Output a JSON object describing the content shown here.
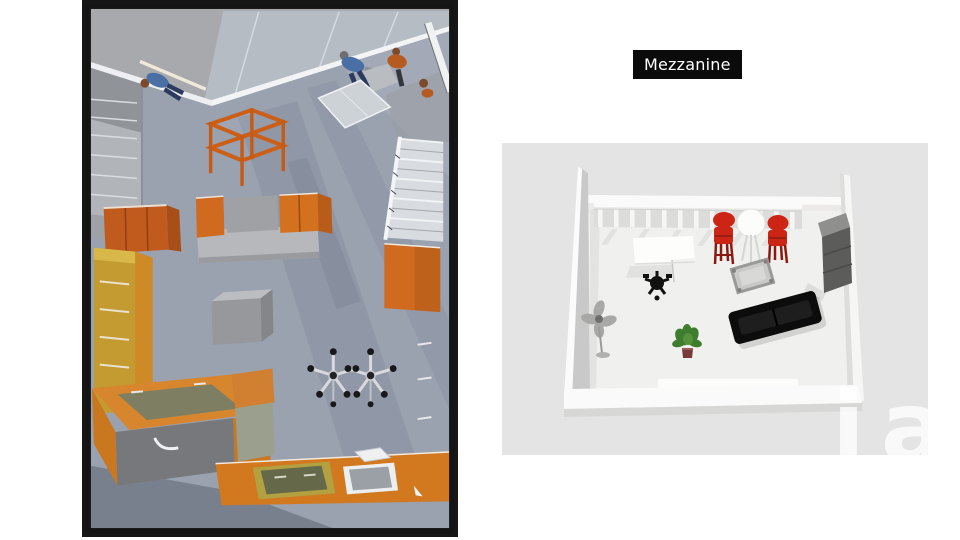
{
  "page": {
    "background": "#ffffff"
  },
  "mezzanine_label": {
    "text": "Mezzanine"
  },
  "left_render": {
    "type": "3d-top-view-render",
    "objects": [
      "workers",
      "storage-rack",
      "skylight-panel",
      "staircase",
      "wall-cabinets",
      "island-cabinet",
      "tall-cabinet",
      "storage-box",
      "orange-wall-panel",
      "lab-stools",
      "sink-counter",
      "floor-hatches"
    ]
  },
  "right_render": {
    "type": "3d-floorplan-model",
    "watermark": "iad",
    "objects": [
      "balustrade",
      "desk",
      "office-chair",
      "bar-stools",
      "round-table",
      "coffee-table",
      "sofa",
      "cabinet",
      "standing-fan",
      "potted-plant"
    ]
  },
  "colors": {
    "page_bg": "#ffffff",
    "label_bg": "#0b0b0b",
    "label_text": "#ffffff",
    "frame_black": "#161616",
    "left_outer_gray": "#a8a9ad",
    "left_floor_gray": "#9aa1af",
    "accent_orange": "#d06a1e",
    "counter_orange": "#d8862e",
    "tan_yellow": "#c49b31",
    "right_bg": "#e4e4e4",
    "right_floor": "#f0f0ee",
    "wall_white": "#fafafa",
    "stool_red": "#cc2516",
    "sofa_black": "#0c0c0c",
    "plant_green": "#3f7d2e"
  }
}
